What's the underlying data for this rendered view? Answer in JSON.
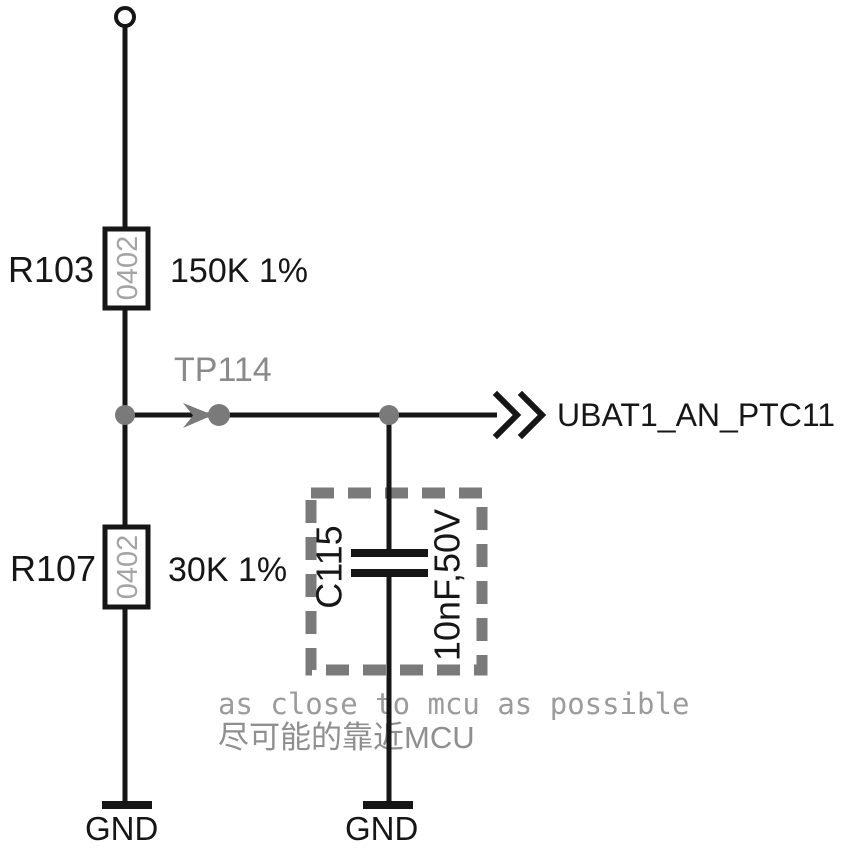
{
  "schematic": {
    "kind": "analog input voltage divider with filter capacitor",
    "colors": {
      "background": "#ffffff",
      "wire_black": "#161616",
      "component_gray": "#7a7a7a",
      "testpoint_gray": "#8a8a8a",
      "package_text_gray": "#a4a4a4",
      "note_gray": "#9b9b9b"
    },
    "resistors": [
      {
        "ref": "R103",
        "package": "0402",
        "value": "150K 1%"
      },
      {
        "ref": "R107",
        "package": "0402",
        "value": "30K 1%"
      }
    ],
    "capacitor": {
      "ref": "C115",
      "value": "10nF,50V"
    },
    "testpoint": {
      "ref": "TP114"
    },
    "net": {
      "label": "UBAT1_AN_PTC11"
    },
    "grounds": {
      "left": "GND",
      "right": "GND"
    },
    "notes": {
      "english": "as close to mcu as possible",
      "chinese": "尽可能的靠近MCU"
    }
  }
}
